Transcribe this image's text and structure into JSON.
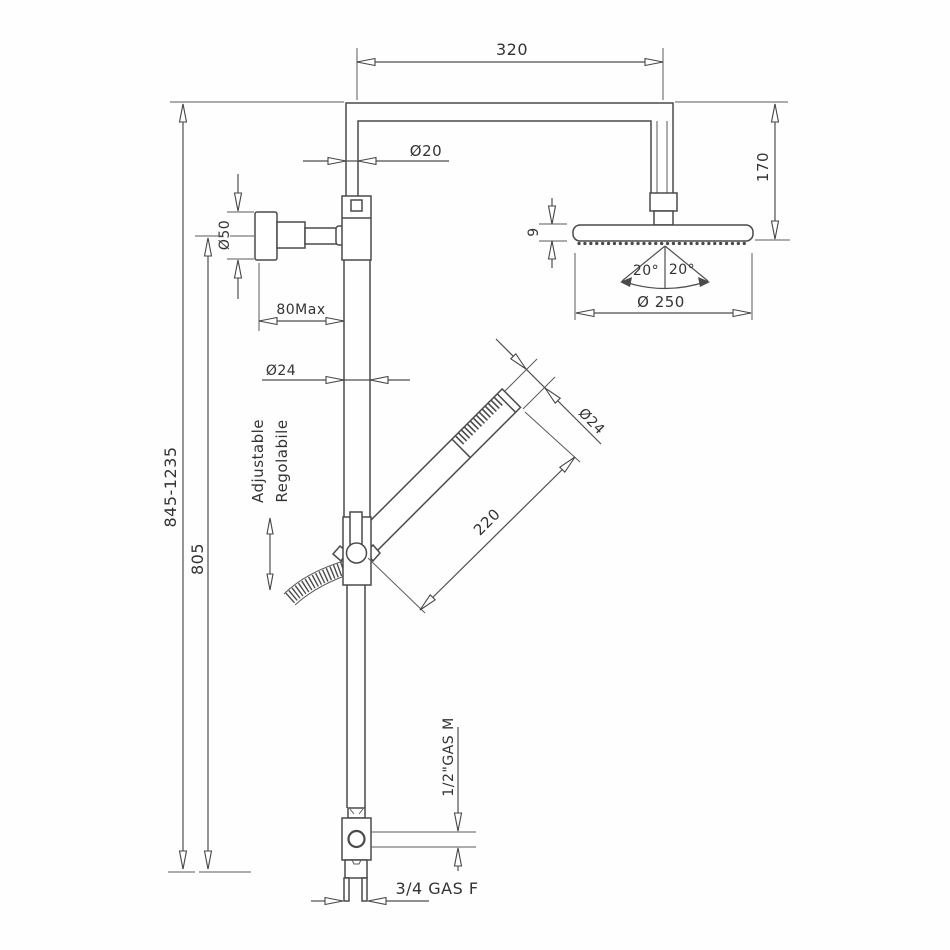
{
  "drawing": {
    "type": "shower-column-technical-drawing",
    "line_color": "#4a4a4a",
    "text_color": "#333333",
    "labels": {
      "arm_length": "320",
      "pipe_diameter": "Ø20",
      "head_offset": "170",
      "head_thickness": "9",
      "angle_left": "20°",
      "angle_right": "20°",
      "head_diameter": "Ø 250",
      "flange_diameter": "Ø50",
      "wall_distance": "80Max",
      "column_diameter": "Ø24",
      "handshower_diameter": "Ø24",
      "handshower_length": "220",
      "overall_height": "845-1235",
      "fixed_height": "805",
      "adjustable_en": "Adjustable",
      "adjustable_it": "Regolabile",
      "outlet_thread": "1/2\"GAS M",
      "inlet_thread": "3/4 GAS F"
    }
  }
}
